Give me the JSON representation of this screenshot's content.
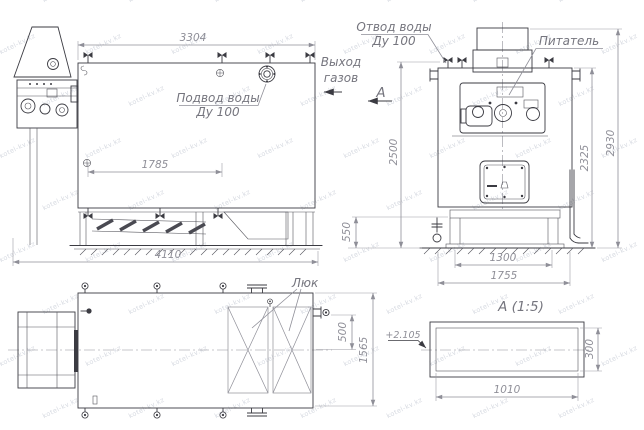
{
  "watermark": {
    "text": "kotel-kv.kz",
    "color": "#cdd1da"
  },
  "colors": {
    "line": "#3b3b42",
    "dimension": "#8f8f98",
    "label": "#75757e",
    "background": "#ffffff"
  },
  "side_view": {
    "label_water_supply_line1": "Подвод воды",
    "label_water_supply_line2": "Ду 100",
    "dim_top": "3304",
    "dim_inner": "1785",
    "dim_overall": "4110"
  },
  "front_view": {
    "label_water_outlet_line1": "Отвод воды",
    "label_water_outlet_line2": "Ду 100",
    "label_gas_exit_line1": "Выход",
    "label_gas_exit_line2": "газов",
    "label_feeder": "Питатель",
    "label_section_arrow": "А",
    "dim_height_left": "2500",
    "dim_base_height": "550",
    "dim_width_inner": "1300",
    "dim_width_outer": "1755",
    "dim_height_right_inner": "2325",
    "dim_height_right_outer": "2930"
  },
  "plan_view": {
    "label_hatch": "Люк",
    "dim_offset": "500",
    "dim_width": "1565"
  },
  "section_view": {
    "title": "А  (1:5)",
    "elevation_mark": "+2.105",
    "dim_width": "1010",
    "dim_height": "300"
  }
}
